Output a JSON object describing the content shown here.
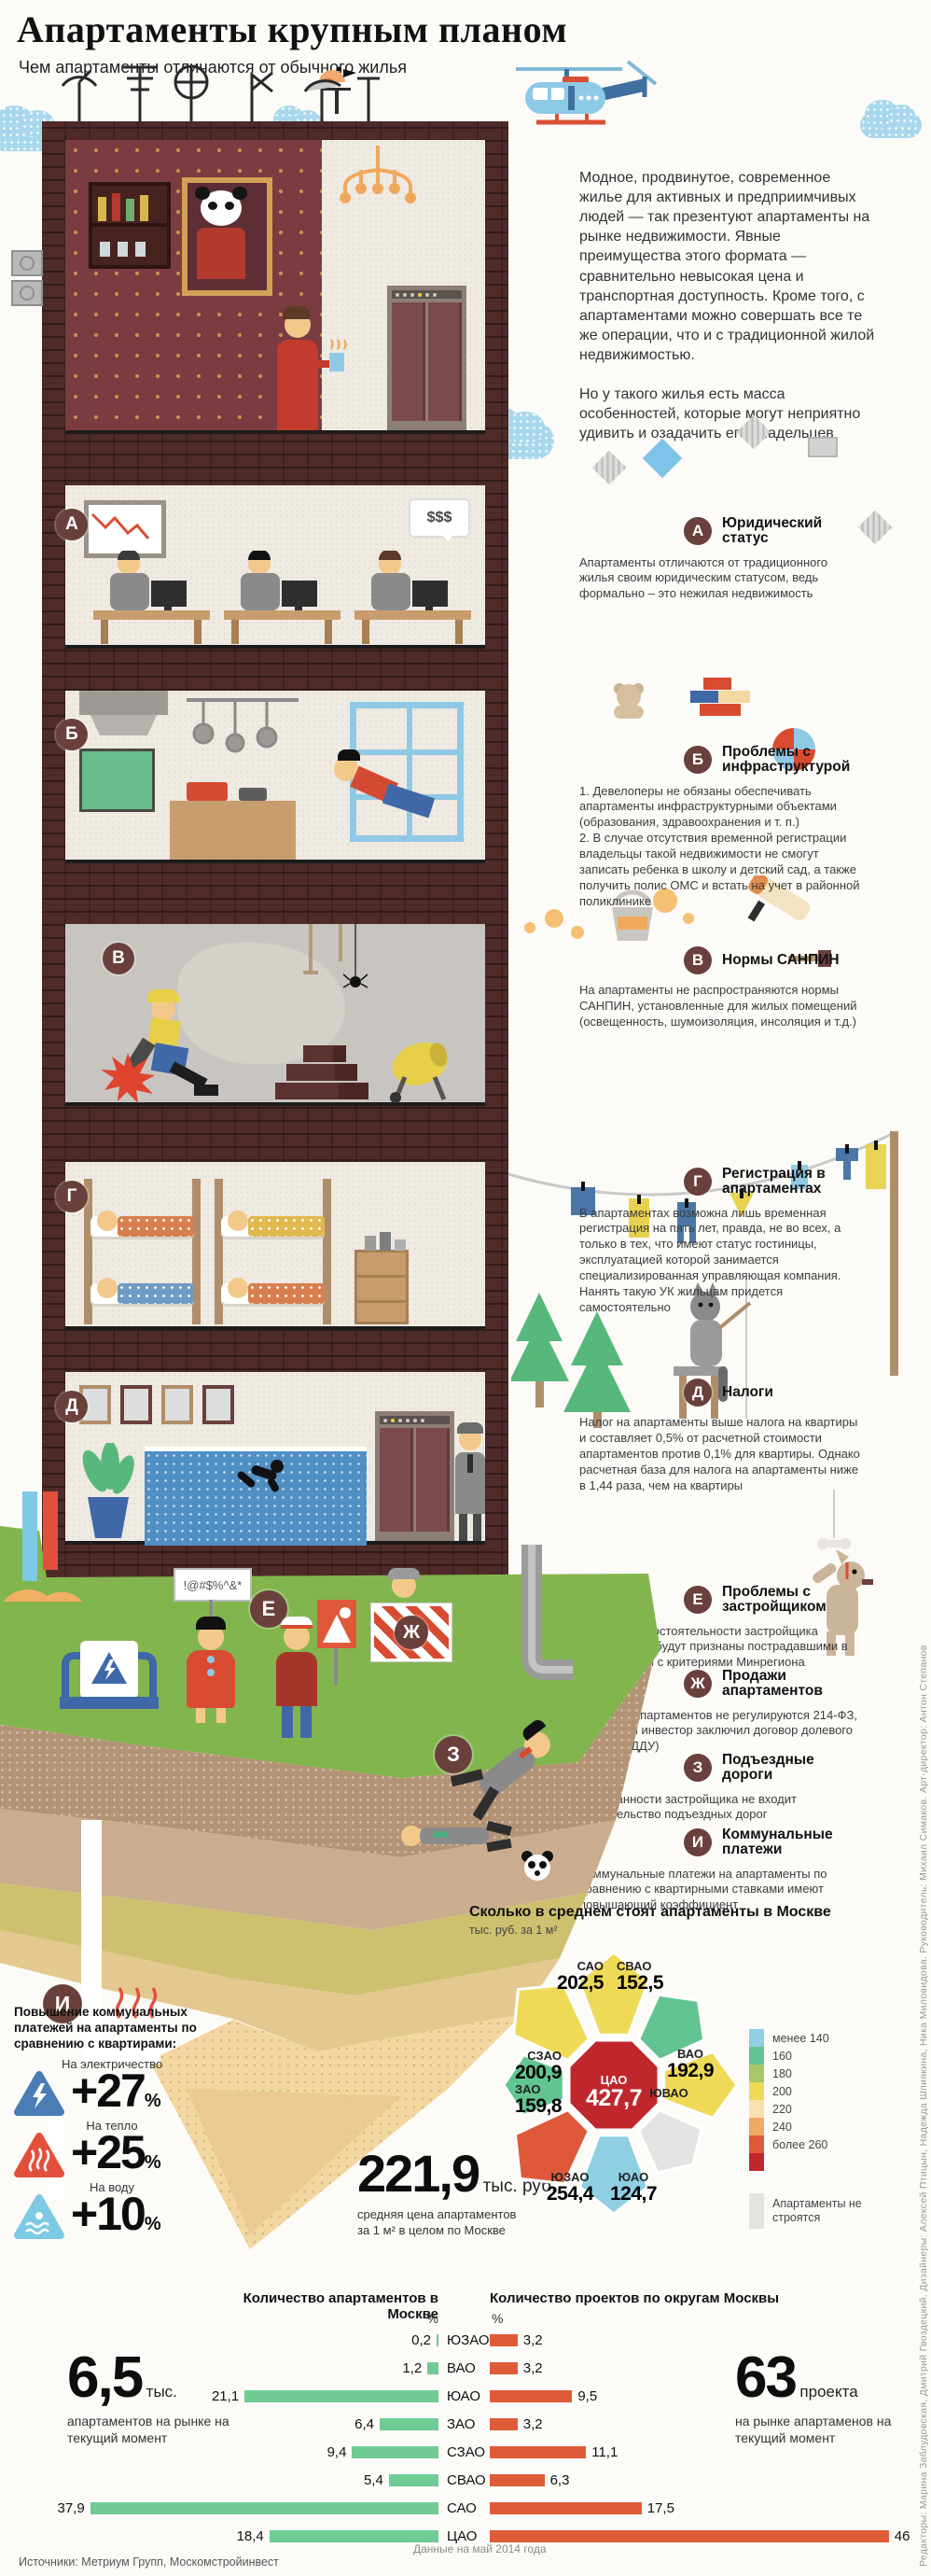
{
  "header": {
    "title": "Апартаменты крупным планом",
    "subtitle": "Чем апартаменты отличаются от обычного жилья"
  },
  "intro": {
    "p1": "Модное, продвинутое, современное жилье для активных и предприимчивых людей — так презентуют апартаменты на рынке недвижимости. Явные преимущества этого формата — сравнительно невысокая цена и транспортная доступность. Кроме того, с апартаментами можно совершать все те же операции, что и с традиционной жилой недвижимостью.",
    "p2": "Но у такого жилья есть масса особенностей, которые могут неприятно удивить и озадачить его владельцев"
  },
  "sections": [
    {
      "letter": "А",
      "title": "Юридический статус",
      "body": "Апартаменты отличаются от традиционного жилья своим юридическим статусом, ведь формально – это нежилая недвижимость"
    },
    {
      "letter": "Б",
      "title": "Проблемы с инфраструктурой",
      "body": "1. Девелоперы не обязаны обеспечивать апартаменты инфраструктурными объектами (образования, здравоохранения и т. п.)\n2. В случае отсутствия временной регистрации владельцы такой недвижимости не смогут записать ребенка в школу и детский сад, а также получить полис ОМС и встать на учет в районной поликлинике"
    },
    {
      "letter": "В",
      "title": "Нормы САНПИН",
      "body": "На апартаменты не распространяются нормы САНПИН, установленные для жилых помещений (освещенность, шумоизоляция, инсоляция и т.д.)"
    },
    {
      "letter": "Г",
      "title": "Регистрация в апартаментах",
      "body": "В апартаментах возможна лишь временная регистрация на пять лет, правда, не во всех, а только в тех, что имеют статус гостиницы, эксплуатацией которой занимается специализированная управляющая компания. Нанять такую УК жильцам придется самостоятельно"
    },
    {
      "letter": "Д",
      "title": "Налоги",
      "body": "Налог на апартаменты выше налога на квартиры и составляет 0,5% от расчетной стоимости апартаментов против 0,1% для квартиры. Однако расчетная база для налога на апартаменты ниже в 1,44 раза, чем на квартиры"
    },
    {
      "letter": "Е",
      "title": "Проблемы с застройщиком",
      "body": "В случае несостоятельности застройщика дольщики не будут признаны пострадавшими в соответствии с критериями Минрегиона"
    },
    {
      "letter": "Ж",
      "title": "Продажи апартаментов",
      "body": "Продажи апартаментов не регулируются 214-ФЗ, даже если инвестор заключил договор долевого участия (ДДУ)"
    },
    {
      "letter": "З",
      "title": "Подъездные дороги",
      "body": "В обязанности застройщика не входит строительство подъездных дорог"
    },
    {
      "letter": "И",
      "title": "Коммунальные платежи",
      "body": "Коммунальные платежи на апартаменты по сравнению с квартирными ставками имеют повышающий коэффициент"
    }
  ],
  "illustration": {
    "office_bubble": "$$$",
    "protest_sign": "!@#$%^&*"
  },
  "utilities": {
    "heading": "Повышение коммунальных платежей на апартаменты по сравнению с квартирами:",
    "items": [
      {
        "label": "На электричество",
        "value": "+27",
        "unit": "%",
        "icon": "electricity-warning-icon",
        "color": "#4a7db5"
      },
      {
        "label": "На тепло",
        "value": "+25",
        "unit": "%",
        "icon": "heat-warning-icon",
        "color": "#e2503c"
      },
      {
        "label": "На воду",
        "value": "+10",
        "unit": "%",
        "icon": "water-warning-icon",
        "color": "#7ec9e3"
      }
    ]
  },
  "chart_data": [
    {
      "type": "heatmap",
      "subtype": "choropleth-map-moscow",
      "title": "Сколько в среднем стоят апартаменты в Москве",
      "unit_label": "тыс. руб. за 1 м²",
      "districts": [
        {
          "name": "САО",
          "value": 202.5,
          "value_label": "202,5",
          "color": "#eeda57"
        },
        {
          "name": "СВАО",
          "value": 152.5,
          "value_label": "152,5",
          "color": "#62c491"
        },
        {
          "name": "ВАО",
          "value": 192.9,
          "value_label": "192,9",
          "color": "#eeda57"
        },
        {
          "name": "ЮВАО",
          "value": null,
          "value_label": "",
          "color": "#e4e3e1"
        },
        {
          "name": "ЮАО",
          "value": 124.7,
          "value_label": "124,7",
          "color": "#8fcfe4"
        },
        {
          "name": "ЮЗАО",
          "value": 254.4,
          "value_label": "254,4",
          "color": "#e0583a"
        },
        {
          "name": "ЗАО",
          "value": 159.8,
          "value_label": "159,8",
          "color": "#62c491"
        },
        {
          "name": "СЗАО",
          "value": 200.9,
          "value_label": "200,9",
          "color": "#eeda57"
        },
        {
          "name": "ЦАО",
          "value": 427.7,
          "value_label": "427,7",
          "color": "#c0272d"
        }
      ],
      "legend": {
        "items": [
          {
            "color": "#8fcfe4",
            "label": "менее 140"
          },
          {
            "color": "#62c491",
            "label": "160"
          },
          {
            "color": "#a8c768",
            "label": "180"
          },
          {
            "color": "#eeda57",
            "label": "200"
          },
          {
            "color": "#f9e0ae",
            "label": "220"
          },
          {
            "color": "#f2a963",
            "label": "240"
          },
          {
            "color": "#e0583a",
            "label": "более 260"
          },
          {
            "color": "#c0272d",
            "label": ""
          }
        ],
        "note": {
          "color": "#e4e3e1",
          "label": "Апартаменты не строятся"
        }
      },
      "highlight": {
        "value": "221,9",
        "unit": "тыс. руб.",
        "caption": "средняя цена апартаментов за 1 м² в целом по Москве"
      }
    },
    {
      "type": "bar",
      "title": "Количество апартаментов в Москве",
      "unit": "%",
      "color": "#6fcb92",
      "categories": [
        "ЮЗАО",
        "ВАО",
        "ЮАО",
        "ЗАО",
        "СЗАО",
        "СВАО",
        "САО",
        "ЦАО"
      ],
      "values": [
        0.2,
        1.2,
        21.1,
        6.4,
        9.4,
        5.4,
        37.9,
        18.4
      ],
      "value_labels": [
        "0,2",
        "1,2",
        "21,1",
        "6,4",
        "9,4",
        "5,4",
        "37,9",
        "18,4"
      ],
      "highlight": {
        "value": "6,5",
        "unit": "тыс.",
        "caption": "апартаментов на рынке на текущий момент"
      }
    },
    {
      "type": "bar",
      "title": "Количество проектов по округам Москвы",
      "unit": "%",
      "color": "#df5b38",
      "categories": [
        "ЮЗАО",
        "ВАО",
        "ЮАО",
        "ЗАО",
        "СЗАО",
        "СВАО",
        "САО",
        "ЦАО"
      ],
      "values": [
        3.2,
        3.2,
        9.5,
        3.2,
        11.1,
        6.3,
        17.5,
        46
      ],
      "value_labels": [
        "3,2",
        "3,2",
        "9,5",
        "3,2",
        "11,1",
        "6,3",
        "17,5",
        "46"
      ],
      "highlight": {
        "value": "63",
        "unit": "проекта",
        "caption": "на рынке апартаменов на текущий момент"
      }
    }
  ],
  "footer": {
    "sources": "Источники: Метриум Групп, Москомстройинвест",
    "data_note": "Данные на май 2014 года"
  },
  "credits": "Редакторы: Марина Заблудовская, Дмитрий Гвоздецкий. Дизайнеры: Алексей Птицын, Надежда Шпиякина, Ника Миловидова. Руководитель: Михаил Симаков. Арт-директор: Антон Степанов"
}
